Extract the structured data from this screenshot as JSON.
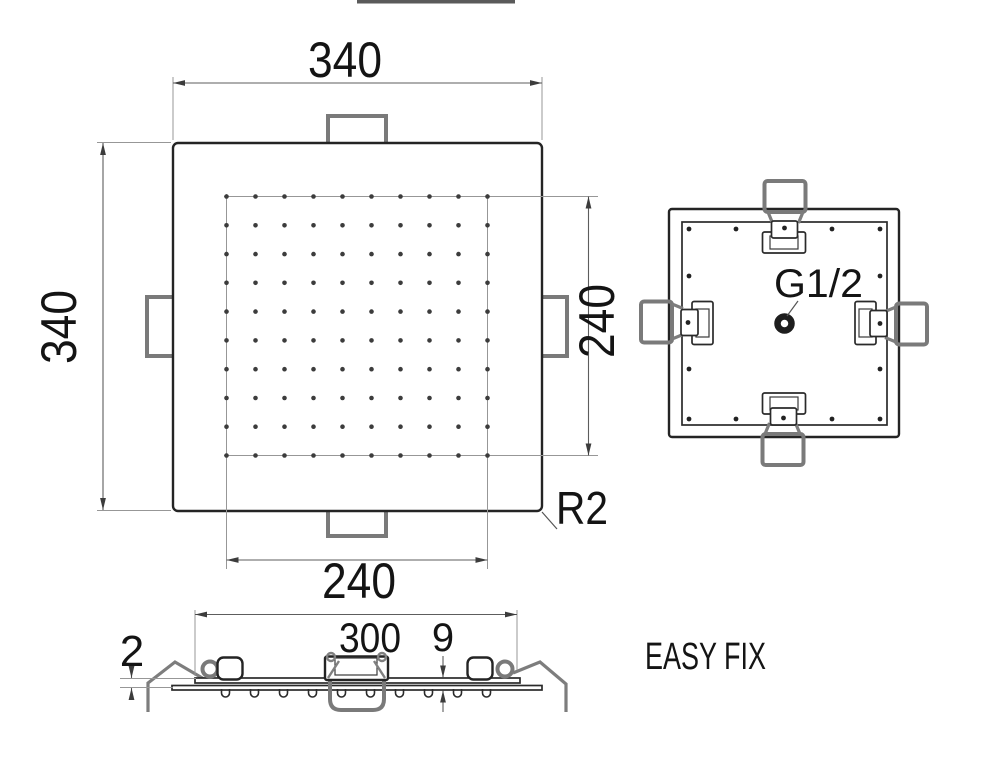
{
  "views": {
    "front": {
      "dim_width": "340",
      "dim_height": "340",
      "dim_nozzle_width": "240",
      "dim_nozzle_height": "240",
      "corner_radius": "R2",
      "nozzle_rows": 10,
      "nozzle_cols": 10
    },
    "rear": {
      "connection": "G1/2"
    },
    "side": {
      "dim_thickness": "2",
      "dim_clip_span": "300",
      "dim_depth": "9",
      "nozzle_count": 10
    },
    "caption": "EASY FIX"
  }
}
